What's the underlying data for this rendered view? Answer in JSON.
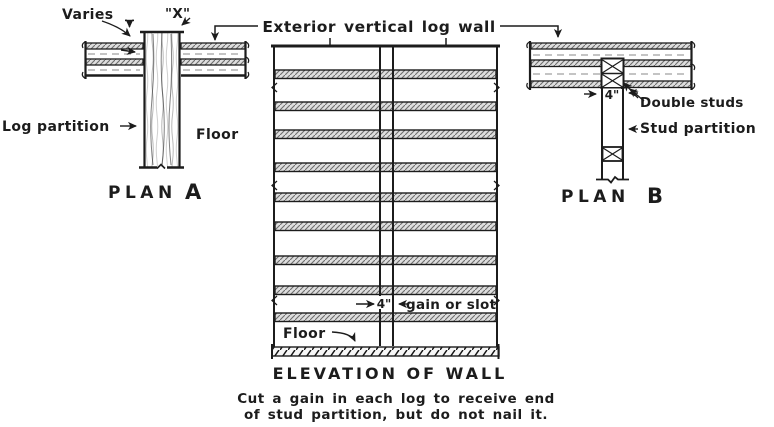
{
  "colors": {
    "ink": "#1c1c1c",
    "paper": "#ffffff"
  },
  "top": {
    "exterior_wall_label": "Exterior vertical log wall"
  },
  "plan_a": {
    "varies_label": "Varies",
    "x_label": "\"X\"",
    "log_partition_label": "Log partition",
    "floor_label": "Floor",
    "title_word": "PLAN",
    "title_letter": "A"
  },
  "plan_b": {
    "dim_label": "4\"",
    "double_studs_label": "Double studs",
    "stud_partition_label": "Stud partition",
    "title_word": "PLAN",
    "title_letter": "B"
  },
  "elevation": {
    "dim_label": "4\"",
    "gain_label": "gain or slot",
    "floor_label": "Floor",
    "title": "ELEVATION OF WALL",
    "caption_line1": "Cut a gain in each log to receive end",
    "caption_line2": "of stud partition, but do not nail it."
  }
}
